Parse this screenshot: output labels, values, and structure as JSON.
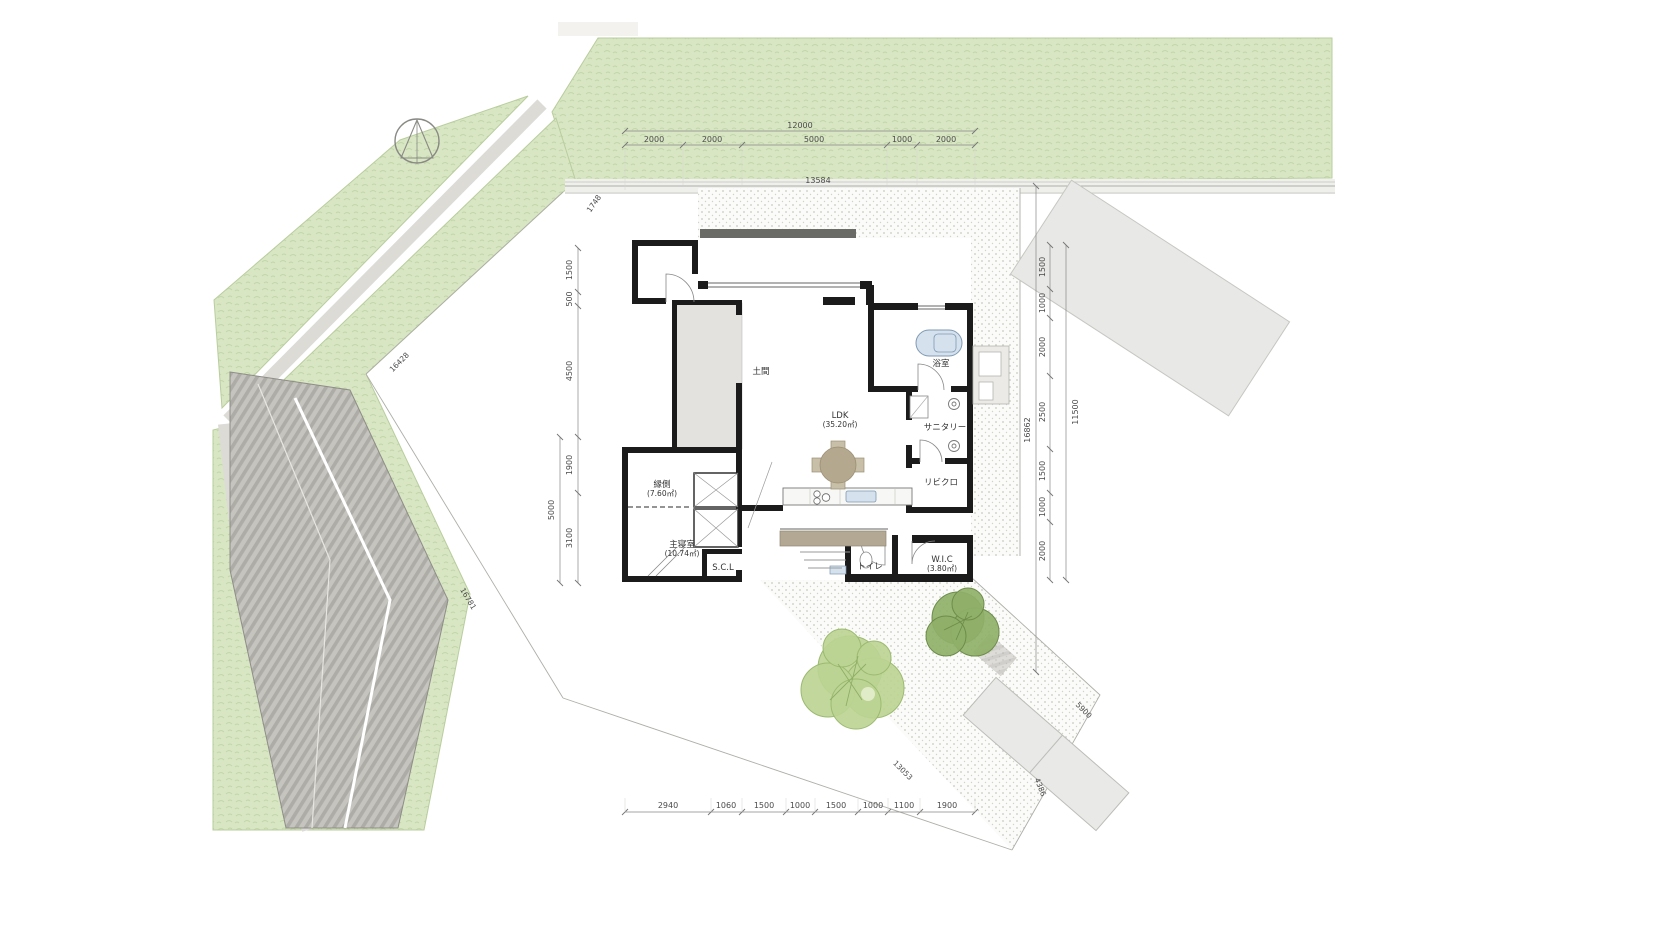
{
  "drawing": {
    "type": "architectural-site-plan",
    "room_labels": {
      "doma": "土間",
      "ldk_name": "LDK",
      "ldk_area": "(35.20㎡)",
      "bath": "浴室",
      "sanitary": "サニタリー",
      "living_closet": "リビクロ",
      "wic_name": "W.I.C",
      "wic_area": "(3.80㎡)",
      "toilet": "トイレ",
      "scl": "S.C.L",
      "bedroom_name": "主寝室",
      "bedroom_area": "(10.74㎡)",
      "engawa_name": "縁側",
      "engawa_area": "(7.60㎡)"
    },
    "dims": {
      "top_overall": "12000",
      "top_seg": [
        "2000",
        "2000",
        "5000",
        "1000",
        "2000"
      ],
      "north_boundary": "13584",
      "left_seg": [
        "1500",
        "500",
        "4500",
        "1900",
        "3100"
      ],
      "left_overall": "5000",
      "right_seg": [
        "1500",
        "1000",
        "2000",
        "2500",
        "1500",
        "1000",
        "2000"
      ],
      "right_overall": "11500",
      "right_total": "16862",
      "bottom_seg": [
        "2940",
        "1060",
        "1500",
        "1000",
        "1500",
        "1000",
        "1100",
        "1900"
      ],
      "diag_nw": "1748",
      "diag_west": "16428",
      "diag_sw": "16781",
      "diag_drive_sw": "13053",
      "diag_drive_ne": "5900",
      "diag_drive_se": "4386"
    },
    "colors": {
      "vegetation": "#d8e6c4",
      "vegetation_mark": "#c2d7a8",
      "road": "#dcdbd6",
      "roof_stripe_dark": "#aeaca6",
      "roof_stripe_light": "#c6c4be",
      "wall": "#1b1b1b",
      "deck": "#b3a893",
      "water": "#d5e2ee",
      "tree_light": "#bcd492",
      "tree_dark": "#8fb068",
      "gravel_dot": "#c9c9c3",
      "dim_text": "#4a4a4a"
    }
  }
}
